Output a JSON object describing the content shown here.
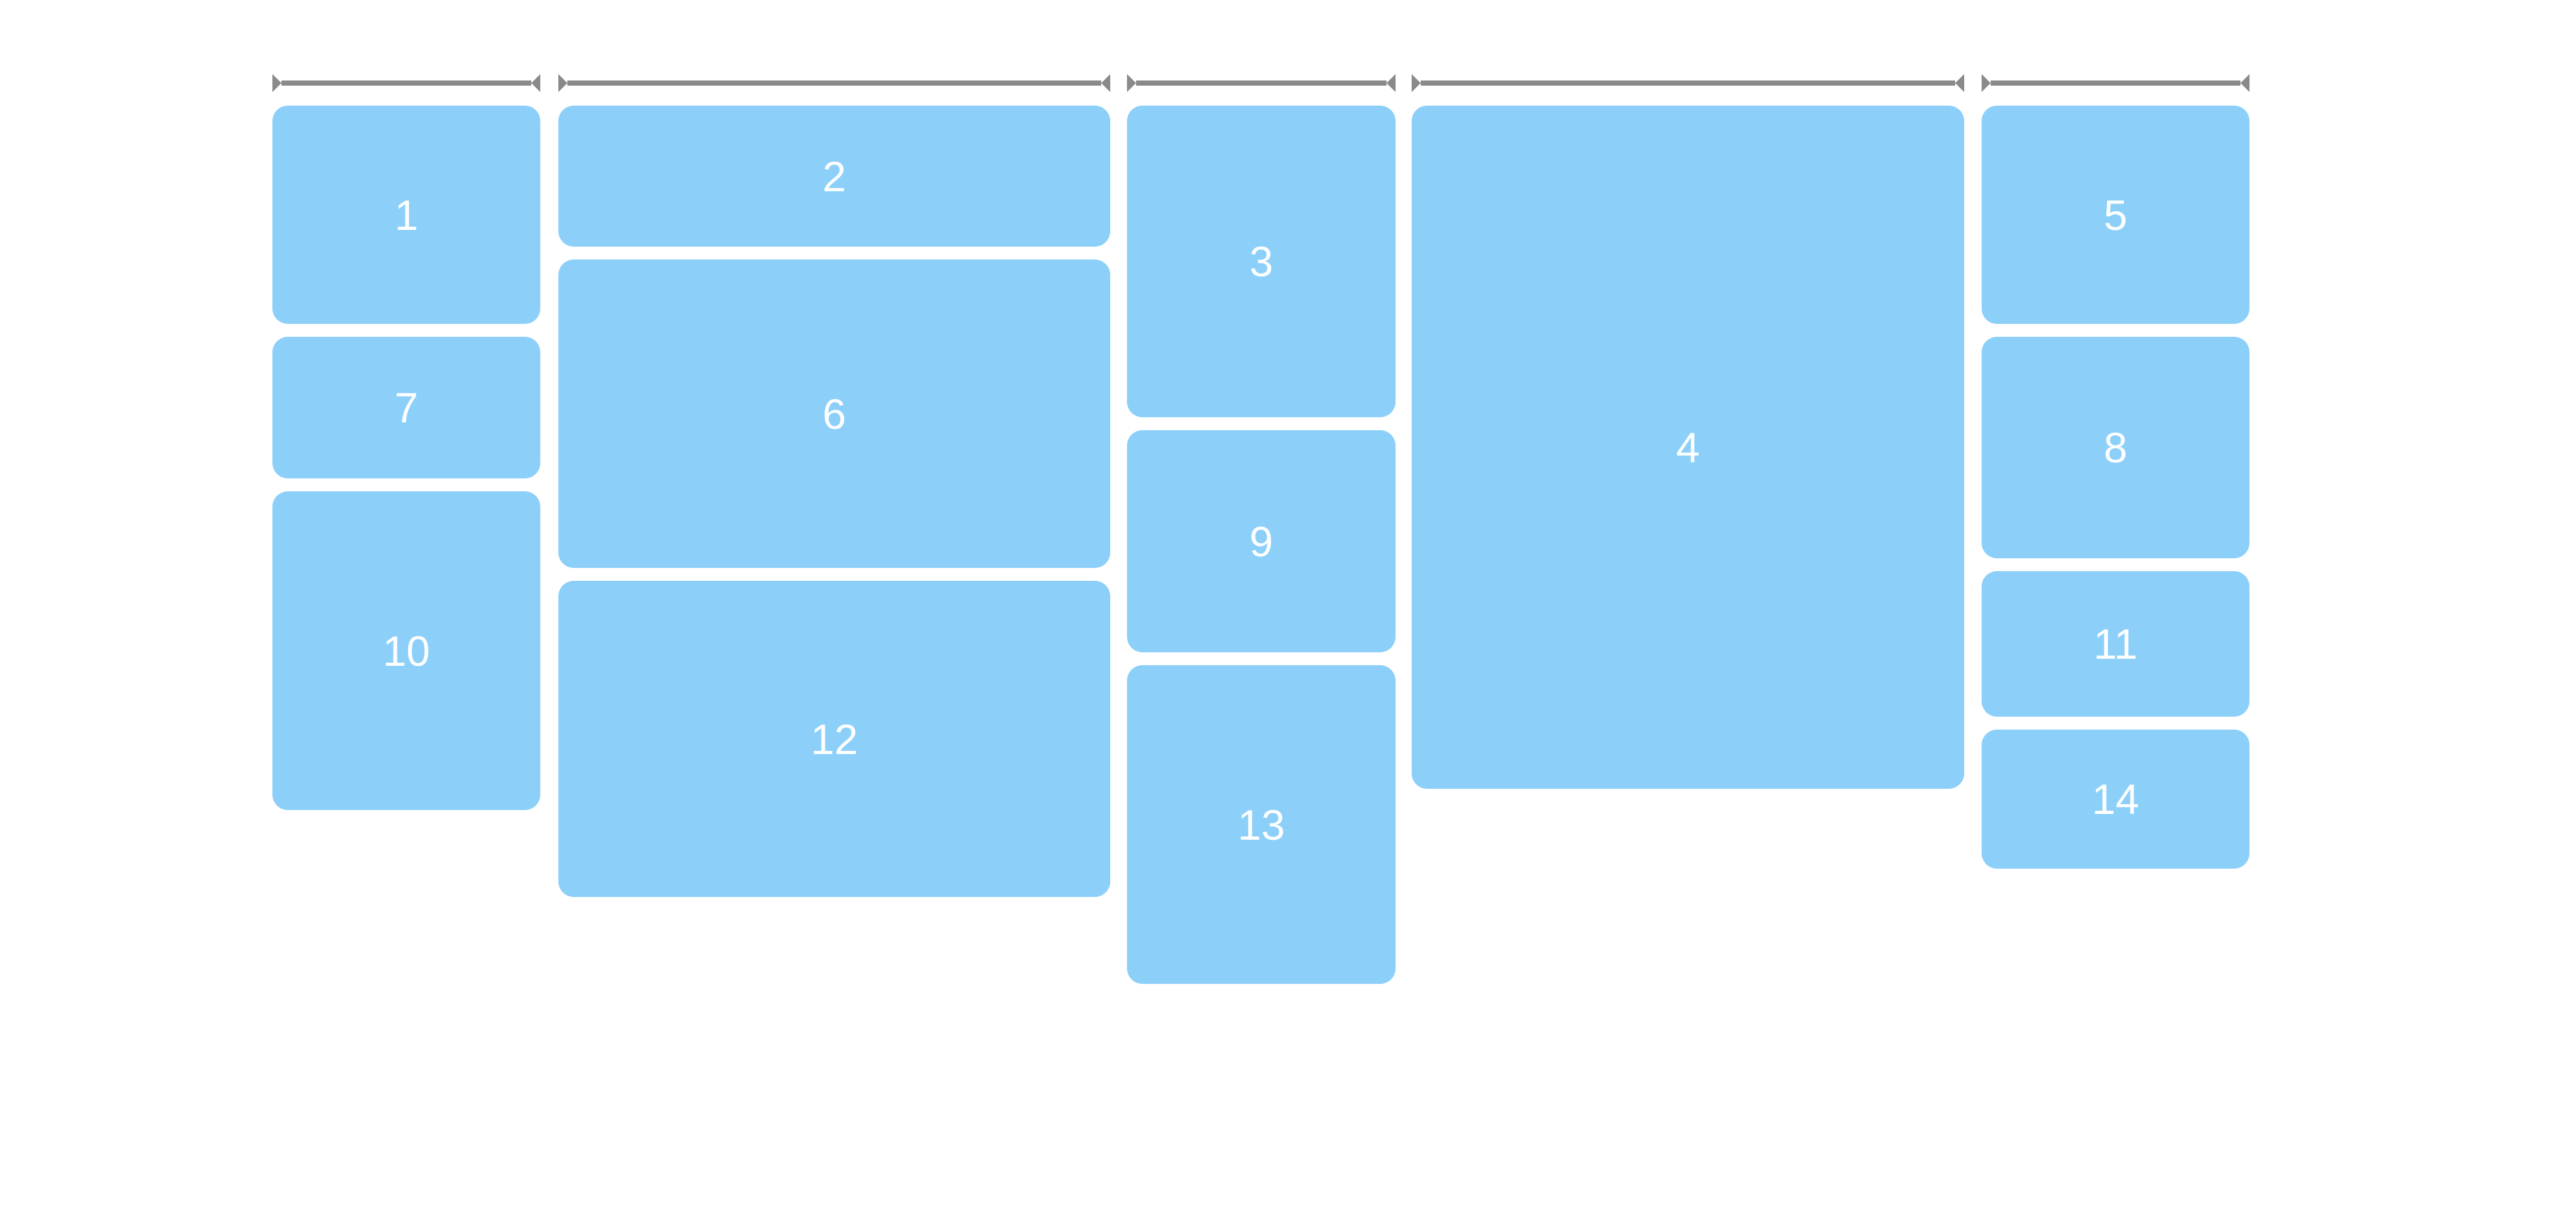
{
  "page": {
    "background": "#ffffff"
  },
  "colors": {
    "item_fill": "#8CD0FA",
    "item_text": "#ffffff",
    "ruler": "#8A8A8A"
  },
  "ruler": {
    "span_count": 5
  },
  "items": [
    {
      "label": "1"
    },
    {
      "label": "2"
    },
    {
      "label": "3"
    },
    {
      "label": "4"
    },
    {
      "label": "5"
    },
    {
      "label": "6"
    },
    {
      "label": "7"
    },
    {
      "label": "8"
    },
    {
      "label": "9"
    },
    {
      "label": "10"
    },
    {
      "label": "11"
    },
    {
      "label": "12"
    },
    {
      "label": "13"
    },
    {
      "label": "14"
    }
  ]
}
